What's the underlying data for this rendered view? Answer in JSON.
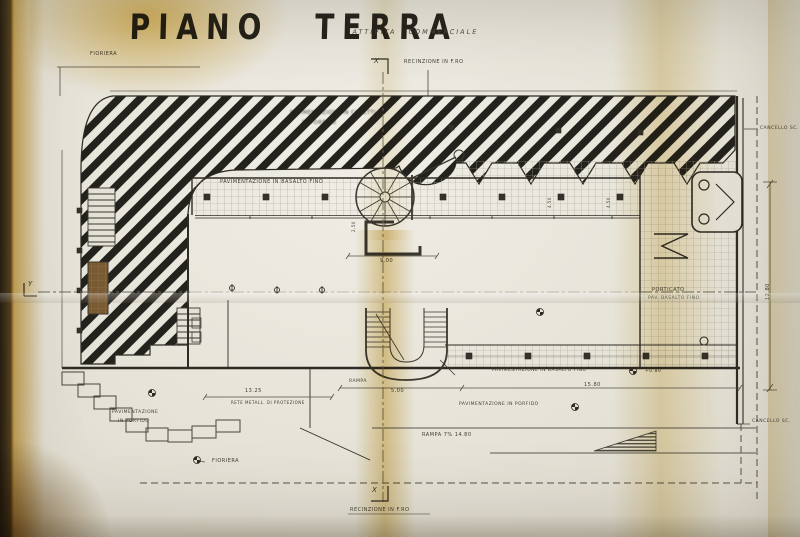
{
  "document": {
    "title": "PIANO TERRA",
    "subtitle": "ATTIVITA COMMERCIALE",
    "type_note": "scanned architectural ground-floor plan, yellowed folded paper"
  },
  "colors": {
    "paper": "#e6e3d8",
    "ink_heavy": "#2e2b25",
    "ink_thin": "#555146",
    "hatch_black": "#24221c",
    "stain_yellow": "#d8a93c",
    "planter_brown": "#7a5a30"
  },
  "labels": [
    {
      "name": "drawing-title",
      "text": "PIANO TERRA",
      "x": 130,
      "y": 10,
      "fs": 28,
      "cls": "title"
    },
    {
      "name": "drawing-subtitle",
      "text": "ATTIVITA COMMERCIALE",
      "x": 353,
      "y": 29,
      "fs": 6.5,
      "cls": "hand"
    },
    {
      "name": "label-fioriera-top",
      "text": "FIORIERA",
      "x": 90,
      "y": 52,
      "fs": 5
    },
    {
      "name": "section-marker-x-top",
      "text": "X",
      "x": 374,
      "y": 58,
      "fs": 7,
      "cls": "marker"
    },
    {
      "name": "label-recinzione-top",
      "text": "RECINZIONE IN F.RO",
      "x": 404,
      "y": 60,
      "fs": 5
    },
    {
      "name": "hatch-note-line1",
      "text": "PAVIMENTAZIONE IN CUBETTI",
      "x": 290,
      "y": 111,
      "fs": 5,
      "cls": "blur"
    },
    {
      "name": "hatch-note-line2",
      "text": "DI PORFIDO",
      "x": 302,
      "y": 121,
      "fs": 5,
      "cls": "blur"
    },
    {
      "name": "label-cancello-top",
      "text": "CANCELLO SC.",
      "x": 760,
      "y": 127,
      "fs": 4.5
    },
    {
      "name": "label-pav-basalto-top",
      "text": "PAVIMENTAZIONE IN BASALTO FINO",
      "x": 220,
      "y": 180,
      "fs": 5
    },
    {
      "name": "dim-4-50-a",
      "text": "4.50",
      "x": 548,
      "y": 208,
      "fs": 4,
      "rot": -90
    },
    {
      "name": "dim-4-50-b",
      "text": "4.50",
      "x": 607,
      "y": 208,
      "fs": 4,
      "rot": -90
    },
    {
      "name": "dim-2-50",
      "text": "2.50",
      "x": 352,
      "y": 232,
      "fs": 4,
      "rot": -90
    },
    {
      "name": "dim-9-00",
      "text": "9.00",
      "x": 380,
      "y": 259,
      "fs": 5
    },
    {
      "name": "section-marker-y-left",
      "text": "Y",
      "x": 28,
      "y": 281,
      "fs": 7,
      "cls": "marker"
    },
    {
      "name": "label-porticato",
      "text": "PORTICATO",
      "x": 652,
      "y": 288,
      "fs": 5
    },
    {
      "name": "label-porticato-pav",
      "text": "PAV. BASALTO FINO",
      "x": 648,
      "y": 297,
      "fs": 4.5
    },
    {
      "name": "dim-12-80",
      "text": "12.80",
      "x": 766,
      "y": 300,
      "fs": 5,
      "rot": -90
    },
    {
      "name": "label-pav-basalto-bottom",
      "text": "PAVIMENTAZIONE IN BASALTO FINO",
      "x": 492,
      "y": 369,
      "fs": 4.5
    },
    {
      "name": "level-plus-080",
      "text": "+0.80",
      "x": 645,
      "y": 370,
      "fs": 4.5
    },
    {
      "name": "label-rampa-small",
      "text": "RAMPA",
      "x": 349,
      "y": 380,
      "fs": 4.5
    },
    {
      "name": "dim-15-80",
      "text": "15.80",
      "x": 584,
      "y": 383,
      "fs": 5
    },
    {
      "name": "dim-5-00",
      "text": "5.00",
      "x": 391,
      "y": 389,
      "fs": 5
    },
    {
      "name": "dim-13-25",
      "text": "13.25",
      "x": 245,
      "y": 389,
      "fs": 5
    },
    {
      "name": "label-rete",
      "text": "RETE METALL. DI PROTEZIONE",
      "x": 231,
      "y": 401,
      "fs": 4
    },
    {
      "name": "label-pav-porfido-bottom",
      "text": "PAVIMENTAZIONE IN PORFIDO",
      "x": 459,
      "y": 403,
      "fs": 4.5
    },
    {
      "name": "label-pav-porfido-left1",
      "text": "PAVIMENTAZIONE",
      "x": 112,
      "y": 411,
      "fs": 4.5
    },
    {
      "name": "label-pav-porfido-left2",
      "text": "IN PORFIDO",
      "x": 118,
      "y": 420,
      "fs": 4.5
    },
    {
      "name": "label-cancello-bottom",
      "text": "CANCELLO SC.",
      "x": 752,
      "y": 420,
      "fs": 4.5
    },
    {
      "name": "label-rampa-main",
      "text": "RAMPA 7% 14.80",
      "x": 422,
      "y": 433,
      "fs": 5
    },
    {
      "name": "label-fioriera-bottom",
      "text": "FIORIERA",
      "x": 212,
      "y": 459,
      "fs": 5
    },
    {
      "name": "section-marker-x-bottom",
      "text": "X",
      "x": 372,
      "y": 487,
      "fs": 7,
      "cls": "marker"
    },
    {
      "name": "label-recinzione-bottom",
      "text": "RECINZIONE IN F.RO",
      "x": 350,
      "y": 508,
      "fs": 5
    }
  ]
}
